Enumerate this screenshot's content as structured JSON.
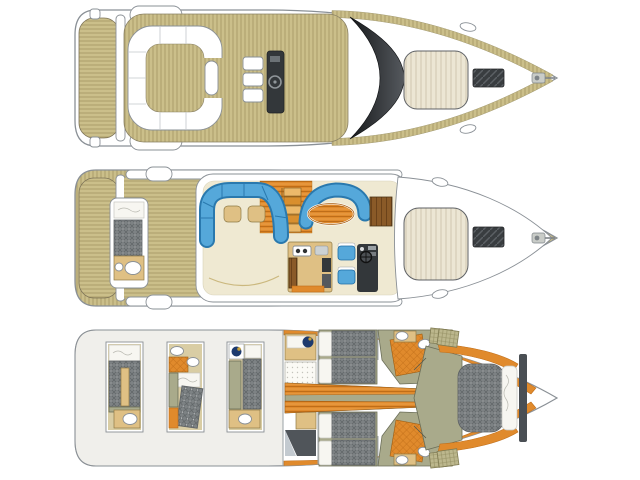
{
  "diagram": {
    "type": "yacht-deck-plan",
    "orientation": "bow-right",
    "decks": [
      {
        "name": "flybridge-deck",
        "features": [
          "swim-platform",
          "radar-arch",
          "u-shaped-settee",
          "cockpit-table",
          "helm-seats",
          "helm-console-with-wheel",
          "windshield",
          "foredeck-sunpad",
          "deck-hatch",
          "anchor-windlass"
        ]
      },
      {
        "name": "main-deck",
        "features": [
          "swim-platform",
          "aft-cockpit-bench",
          "salon-sofa-port",
          "salon-sofa-starboard",
          "dinette-table",
          "companionway-stairs",
          "tv-cabinet",
          "galley-with-cooktop-sink-appliances",
          "helm-seats",
          "helm-console",
          "foredeck-sunpad",
          "deck-hatch",
          "anchor-windlass"
        ]
      },
      {
        "name": "lower-deck",
        "features": [
          "optional-cabin-layout-1",
          "optional-cabin-layout-2",
          "optional-cabin-layout-3",
          "crew-cabin",
          "port-guest-cabin-twin-beds",
          "starboard-guest-cabin-twin-beds",
          "central-corridor",
          "port-bathroom",
          "starboard-bathroom",
          "shower-stalls",
          "vip-bow-cabin-island-bed",
          "wardrobes"
        ]
      }
    ]
  },
  "colors": {
    "hull": "#ffffff",
    "outline": "#8a9096",
    "ghost": "#f0efeb",
    "teak": "#cbbf8a",
    "teak-line": "#a89a66",
    "cream": "#ece6d4",
    "cream-line": "#cfc7b0",
    "dark": "#33373a",
    "glass1": "#17191b",
    "glass2": "#55595e",
    "blue": "#55a8da",
    "blue-dark": "#2a79ae",
    "orange": "#e08a2c",
    "orange-dark": "#bf6d18",
    "tan": "#dfc084",
    "tan-light": "#d9cda4",
    "olive": "#a9aa8b",
    "olive-dark": "#6b6e58",
    "quilt": "#7d8284",
    "quilt-line": "#5f6466",
    "linen": "#f7f6f1",
    "khaki": "#bcb78d",
    "navy": "#1d3a6e",
    "gold": "#c9a23a"
  }
}
